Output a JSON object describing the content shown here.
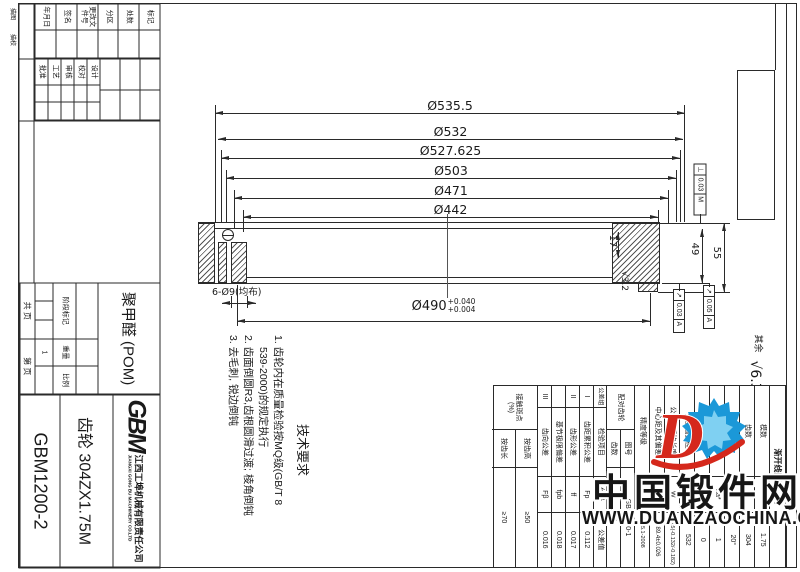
{
  "side_margin_labels": {
    "l1": "描图",
    "l2": "描校"
  },
  "title_block": {
    "rev_rows": [
      "标记",
      "处数",
      "分区",
      "更改文件号",
      "签名",
      "年月日"
    ],
    "sign_rows": [
      "设计",
      "校对",
      "审核",
      "工艺",
      "批准"
    ],
    "material": "聚甲醛 (POM)",
    "stage_label": "阶段标记",
    "weight_label": "重量",
    "scale_label": "比例",
    "weight_value": "1",
    "sheet_total": "共  页",
    "sheet_no": "第  页",
    "logo": "GBM",
    "company_cn": "江西工埠机械有限责任公司",
    "company_en": "JIANGXI GONG BU MACHINERY CO.LTD",
    "part_name": "齿轮 304ZX1.75M",
    "drawing_no": "GBM1200-2"
  },
  "tech_req": {
    "title": "技术要求",
    "line1": "1. 齿轮内在质量检验按MQ级(GB/T 8",
    "line2": "539-2000)的规定执行",
    "line3": "2. 齿面倒圆R3,齿根圆滑过渡; 棱角倒钝",
    "line4": "3. 去毛刺, 锐边倒钝"
  },
  "dims": {
    "d1": "Ø535.5",
    "d2": "Ø532",
    "d3": "Ø527.625",
    "d4": "Ø503",
    "d5": "Ø471",
    "d6": "Ø442",
    "bore": "Ø490",
    "bore_up": "+0.040",
    "bore_low": "+0.004",
    "holes": "6-Ø9(均布)",
    "w17": "17",
    "w49": "49",
    "w55": "55",
    "rough1": "√3.2",
    "rough_rest_label": "其余",
    "rough_rest": "√6.3",
    "fcf1": {
      "sym": "⊥",
      "val": "0.03",
      "ref": "M"
    },
    "fcf2": {
      "sym": "↗",
      "val": "0.03",
      "ref": "A"
    },
    "fcf3": {
      "sym": "↗",
      "val": "0.05",
      "ref": "A"
    }
  },
  "gear_table": {
    "title": "渐开线圆柱齿轮",
    "rows": [
      {
        "label": "模数",
        "sym": "mn",
        "val": "1.75"
      },
      {
        "label": "齿数",
        "sym": "z",
        "val": "304"
      },
      {
        "label": "压力角",
        "sym": "α",
        "val": "20°"
      },
      {
        "label": "齿顶高系数",
        "sym": "ha*",
        "val": "1"
      },
      {
        "label": "变位系数",
        "sym": "x",
        "val": "0"
      },
      {
        "label": "分度圆直径",
        "sym": "d",
        "val": "532"
      },
      {
        "label": "公法线平均长度",
        "sym": "W",
        "val": "480.5(-0.132/-0.182)"
      },
      {
        "label": "中心距及其偏差",
        "sym": "a",
        "val": "289.4±0.026"
      },
      {
        "label": "精度等级",
        "sym": "",
        "val": "7 GB/T10095.1-2008"
      }
    ],
    "mating_label": "配对齿轮",
    "mating_no_label": "图号",
    "mating_no": "GBM1200-1",
    "mating_z_label": "齿数",
    "mating_z": "15",
    "tol_header": {
      "group": "公差组",
      "item": "检验项目",
      "code": "代号",
      "value": "公差值"
    },
    "tol_rows": [
      {
        "group": "I",
        "item": "齿距累积公差",
        "code": "Fp",
        "val": "0.112"
      },
      {
        "group": "II",
        "item": "齿形公差",
        "code": "ff",
        "val": "0.017"
      },
      {
        "group": "",
        "item": "基节极限偏差",
        "code": "fpb",
        "val": "0.018"
      },
      {
        "group": "III",
        "item": "齿向公差",
        "code": "Fβ",
        "val": "0.016"
      }
    ],
    "contact": {
      "label": "接触斑点",
      "pct": "(%)",
      "row1_label": "按齿高",
      "row1_val": "≥50",
      "row2_label": "按齿长",
      "row2_val": "≥70"
    }
  },
  "watermark": {
    "site": "中国锻件网",
    "url": "WWW.DUANZAOCHINA.COM",
    "logo_letter": "D"
  }
}
